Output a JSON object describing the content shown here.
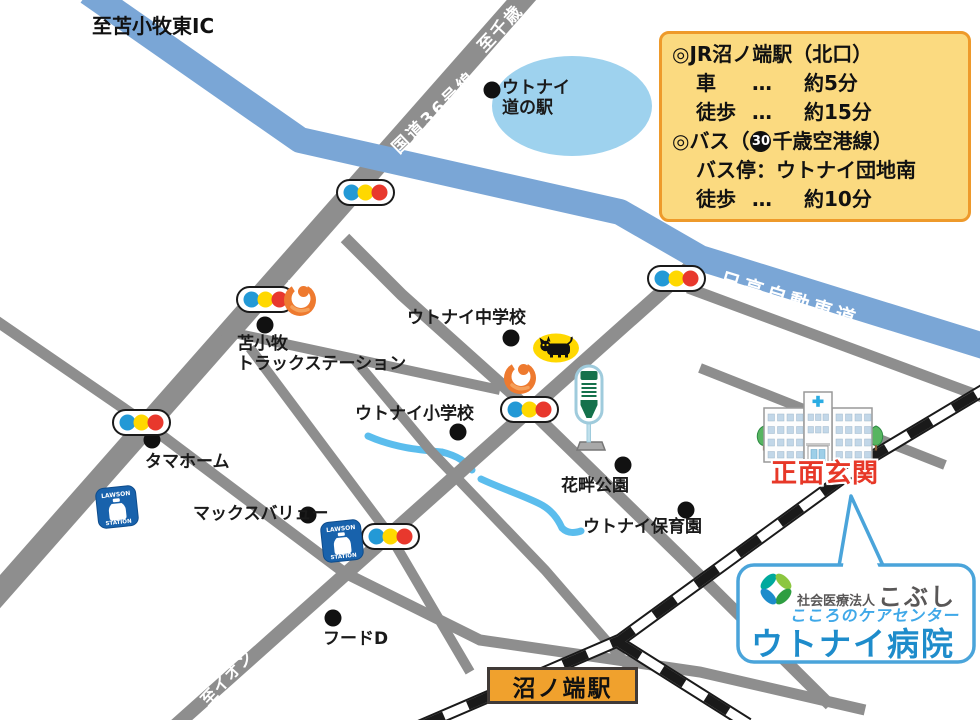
{
  "colors": {
    "road_gray": "#8E8E8E",
    "highway_blue": "#7AA6D6",
    "railway_black": "#1A1A1A",
    "lake_blue": "#9ED2EE",
    "stream_blue": "#5BBDED",
    "signal_blue": "#2399D6",
    "signal_yellow": "#FFD800",
    "signal_red": "#E8382D",
    "lawson_blue": "#1862AC",
    "flame_orange": "#EE7A2F",
    "cat_yellow": "#FFD800",
    "bus_green": "#15714B",
    "hospital_cross_blue": "#29ABE2",
    "entrance_red": "#E73828",
    "station_box_orange": "#F0A12D",
    "info_box_bg": "#FBDA80",
    "info_box_border": "#EE9A2B",
    "bubble_border_blue": "#4AA4DA",
    "hospital_name_blue": "#1E8CCB",
    "care_center_blue": "#3FA8E8",
    "corporation_gray": "#595757"
  },
  "icons": {
    "traffic_light": "traffic-light-icon",
    "lawson": "lawson-logo",
    "flame": "flame-logo",
    "black_cat": "black-cat-logo",
    "bus_stop": "bus-stop-icon",
    "hospital": "hospital-building-icon",
    "tree": "tree-icon",
    "kobushi": "kobushi-flower-logo"
  },
  "road_labels": {
    "to_tomakomai_higashi_ic": "至苫小牧東IC",
    "to_chitose": "至千歳",
    "route36": "国道36号線",
    "hidaka_expressway": "日高自動車道",
    "to_aeon": "至イオン"
  },
  "pois": [
    {
      "line1": "ウトナイ",
      "line2": "道の駅"
    },
    {
      "line1": "苫小牧",
      "line2": "トラックステーション"
    },
    {
      "line1": "ウトナイ中学校"
    },
    {
      "line1": "ウトナイ小学校"
    },
    {
      "line1": "タマホーム"
    },
    {
      "line1": "マックスバリュー"
    },
    {
      "line1": "花畔公園"
    },
    {
      "line1": "ウトナイ保育園"
    },
    {
      "line1": "フードD"
    }
  ],
  "lawson": {
    "top": "LAWSON",
    "bottom": "STATION"
  },
  "info_box": {
    "title": "◎JR沼ノ端駅（北口）",
    "car_label": "車",
    "car_dots": "…",
    "car_value": "約5分",
    "walk1_label": "徒歩",
    "walk1_dots": "…",
    "walk1_value": "約15分",
    "bus_prefix": "◎バス（",
    "bus_number": "30",
    "bus_suffix": "千歳空港線）",
    "bus_stop_line": "バス停：ウトナイ団地南",
    "walk2_label": "徒歩",
    "walk2_dots": "…",
    "walk2_value": "約10分"
  },
  "station_box_label": "沼ノ端駅",
  "entrance_label": "正面玄関",
  "bubble": {
    "corporation_prefix": "社会医療法人",
    "corporation_name": "こぶし",
    "subtitle": "こころのケアセンター",
    "hospital_name": "ウトナイ病院"
  }
}
